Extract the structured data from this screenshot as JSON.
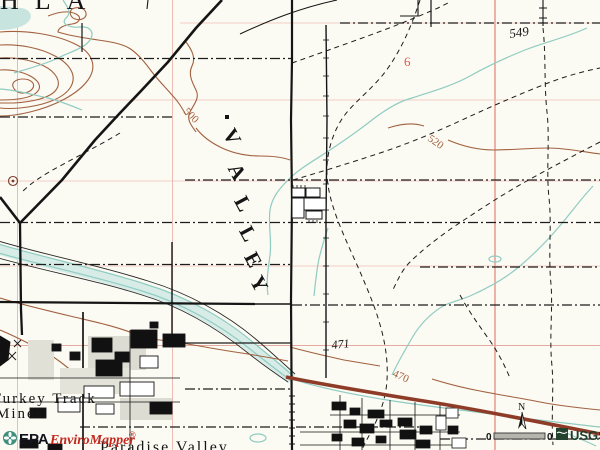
{
  "map": {
    "place_labels": {
      "top_left_partial": "HLA",
      "valley": "VALLEY",
      "valley_letters": [
        "V",
        "A",
        "L",
        "L",
        "E",
        "Y"
      ],
      "turkey_track_line1": "Turkey Track",
      "turkey_track_line2": "Mines",
      "paradise_valley": "Paradise Valley"
    },
    "elevation_labels": {
      "spot_549": "549",
      "spot_471": "471",
      "contour_500": "500",
      "contour_520": "520",
      "contour_470": "470"
    },
    "section_numbers": {
      "six": "6"
    },
    "colors": {
      "paper": "#fbfaf3",
      "contour_brown": "#a2613f",
      "water_teal": "#8fccc2",
      "grid_pink": "#e8b0a8",
      "highway_red": "#8e3c28",
      "section_red": "#e05848"
    }
  },
  "overlay": {
    "epa_logo": {
      "agency": "EPA",
      "product": "EnviroMapper",
      "registered_mark": "®"
    },
    "north_arrow": {
      "label": "N"
    },
    "scale_bar": {
      "left_label": "0",
      "right_label": "0"
    },
    "usgs_logo": {
      "label": "USGS"
    }
  }
}
